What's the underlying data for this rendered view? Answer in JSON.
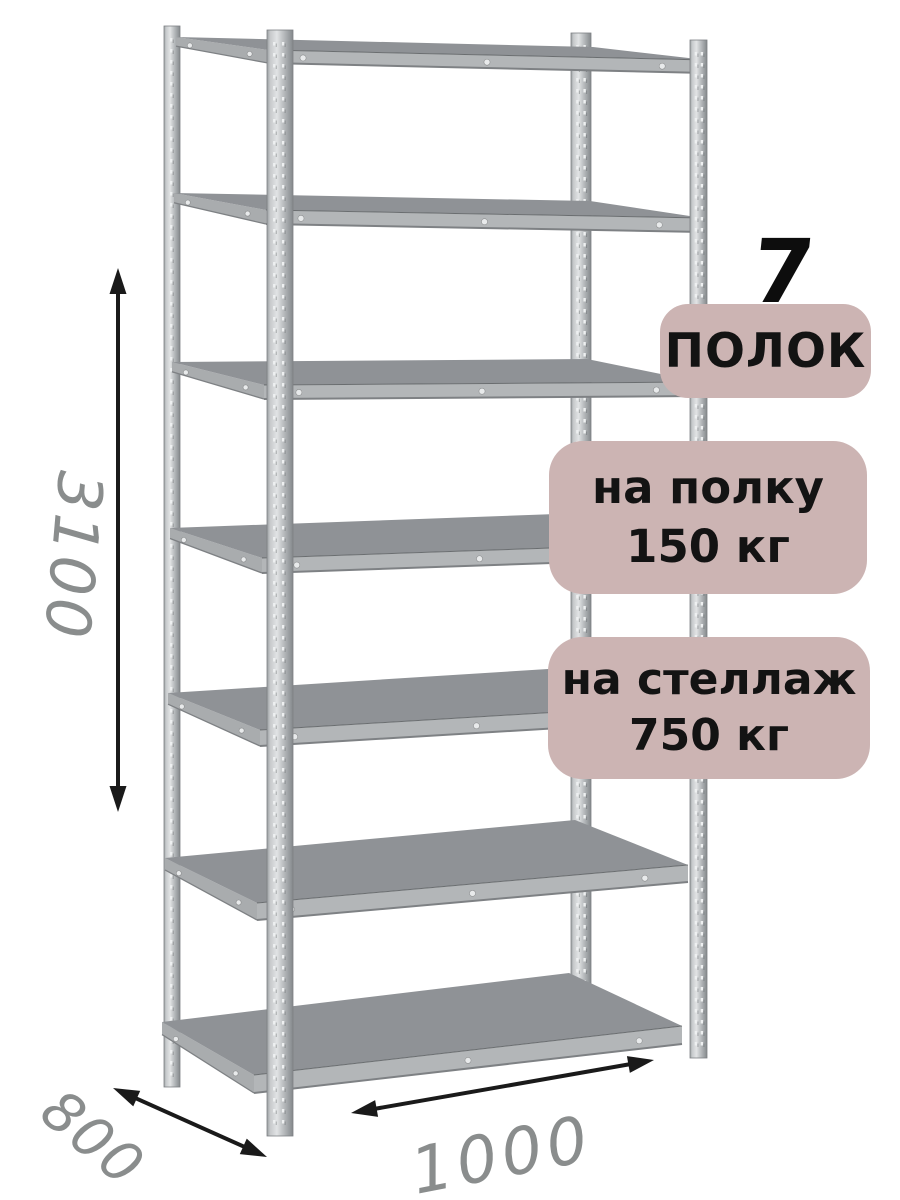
{
  "product": {
    "shelf_count": "7",
    "shelf_count_number": 7
  },
  "badges": {
    "shelves": {
      "label": "ПОЛОК"
    },
    "per_shelf": {
      "line1": "на полку",
      "line2": "150 кг"
    },
    "per_rack": {
      "line1": "на стеллаж",
      "line2": "750 кг"
    }
  },
  "dimensions": {
    "height_mm": "3100",
    "depth_mm": "800",
    "width_mm": "1000"
  },
  "colors": {
    "badge_bg": "#ccb4b3",
    "badge_text": "#131313",
    "dimension_text": "#8a8d8d",
    "arrow": "#1a1a1a",
    "shelf_top": "#8f9296",
    "shelf_edge": "#b3b6b8",
    "shelf_side": "#a9acae",
    "post_light": "#e2e4e5",
    "post_mid": "#c6c9cb",
    "post_dark": "#9a9ea1",
    "outline": "#7e8184"
  }
}
